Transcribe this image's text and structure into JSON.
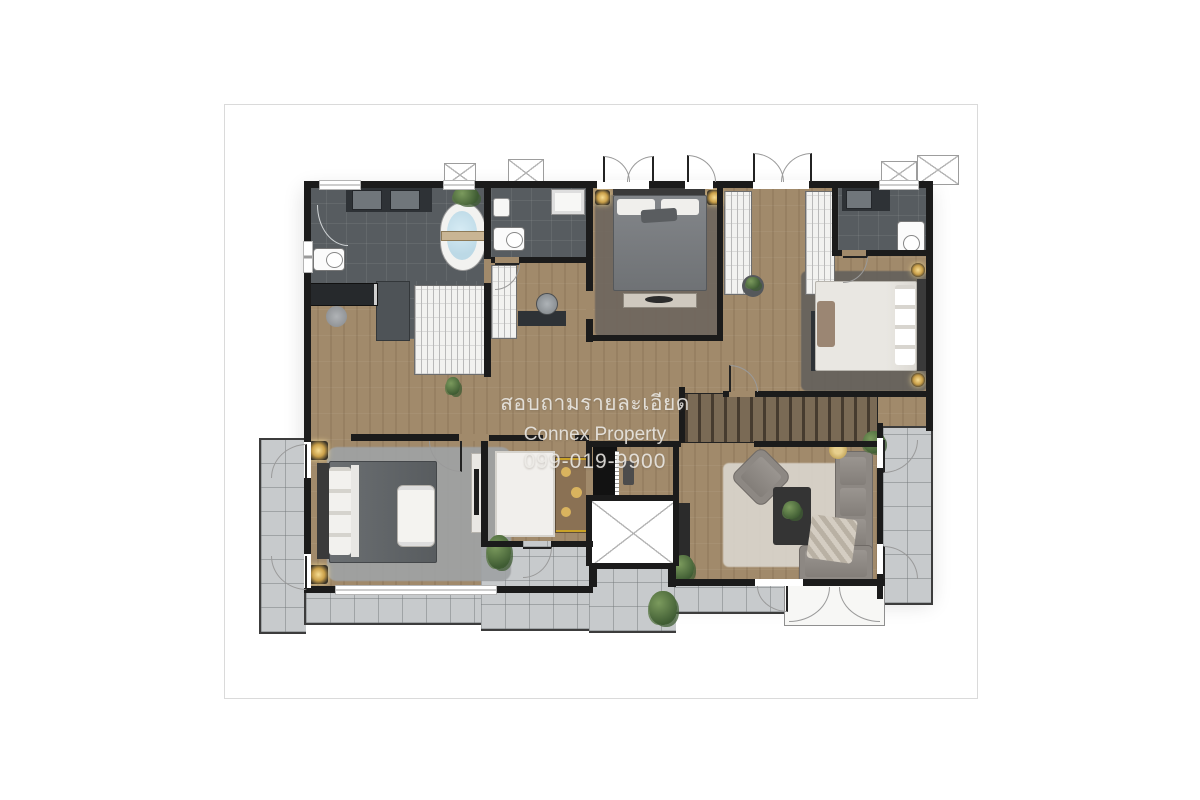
{
  "page": {
    "background": "#ffffff",
    "border_color": "#dadada"
  },
  "watermark": {
    "line1": "สอบถามรายละเอียด",
    "line2": "Connex Property",
    "line3": "099-019-9900",
    "color": "#eceae6"
  },
  "palette": {
    "wall": "#1b1b1b",
    "wood": "#a18a6b",
    "wood_dark": "#8c775c",
    "bath": "#575c60",
    "balcony": "#c7cacc",
    "rug_gray": "#9fa2a4",
    "rug_cream": "#d8d3ca",
    "water": "#bcd9e6",
    "green": "#55713f",
    "gold": "#d9b35e",
    "stair": "#6e5f4e"
  }
}
